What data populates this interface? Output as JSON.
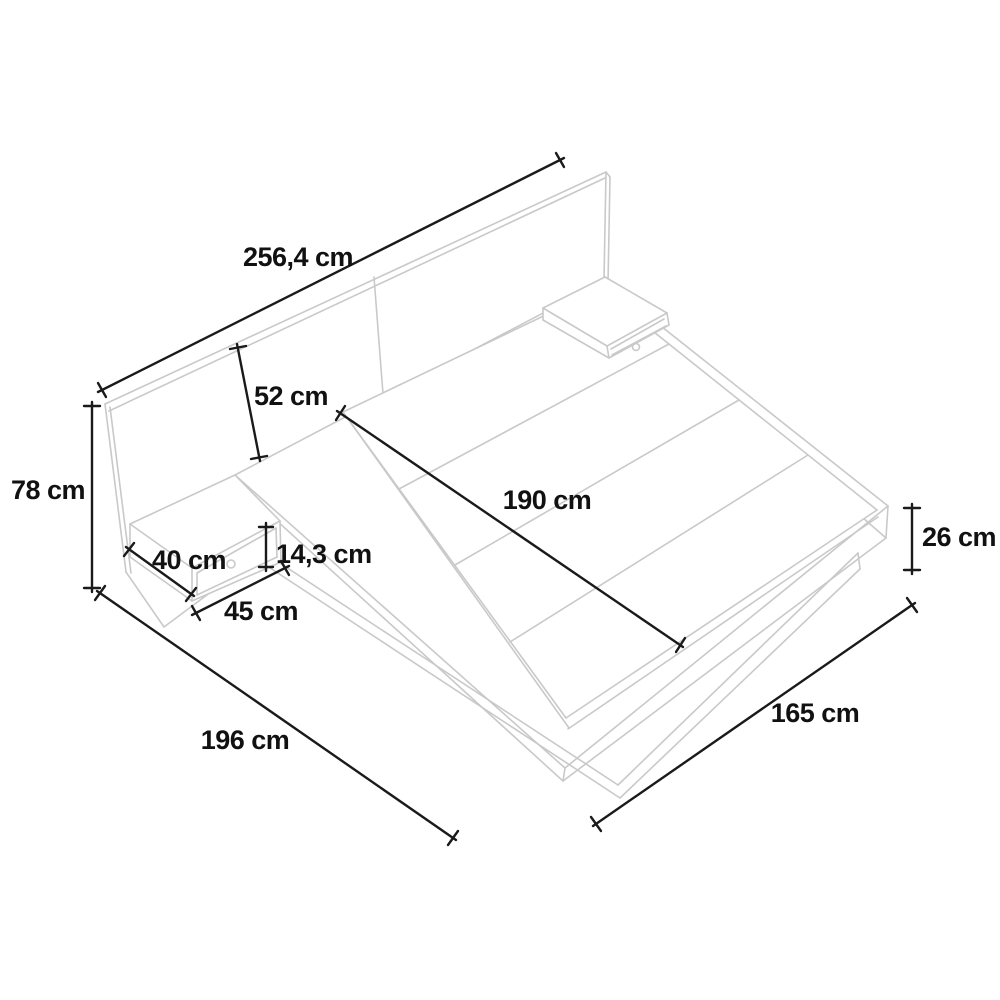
{
  "diagram": {
    "name": "Platform bed with wide headboard and two floating nightstands — dimensioned line drawing",
    "unit": "cm",
    "labels": {
      "headboard_width": "256,4 cm",
      "headboard_visible_height": "52 cm",
      "total_height": "78 cm",
      "mattress_length": "190 cm",
      "nightstand_depth": "40 cm",
      "nightstand_front_height": "14,3 cm",
      "nightstand_width": "45 cm",
      "bed_length": "196 cm",
      "bed_width": "165 cm",
      "platform_height": "26 cm"
    },
    "colors": {
      "background": "#ffffff",
      "structure_line": "#c9c9c9",
      "dimension_line": "#1a1a1a",
      "label_text": "#111111"
    }
  }
}
